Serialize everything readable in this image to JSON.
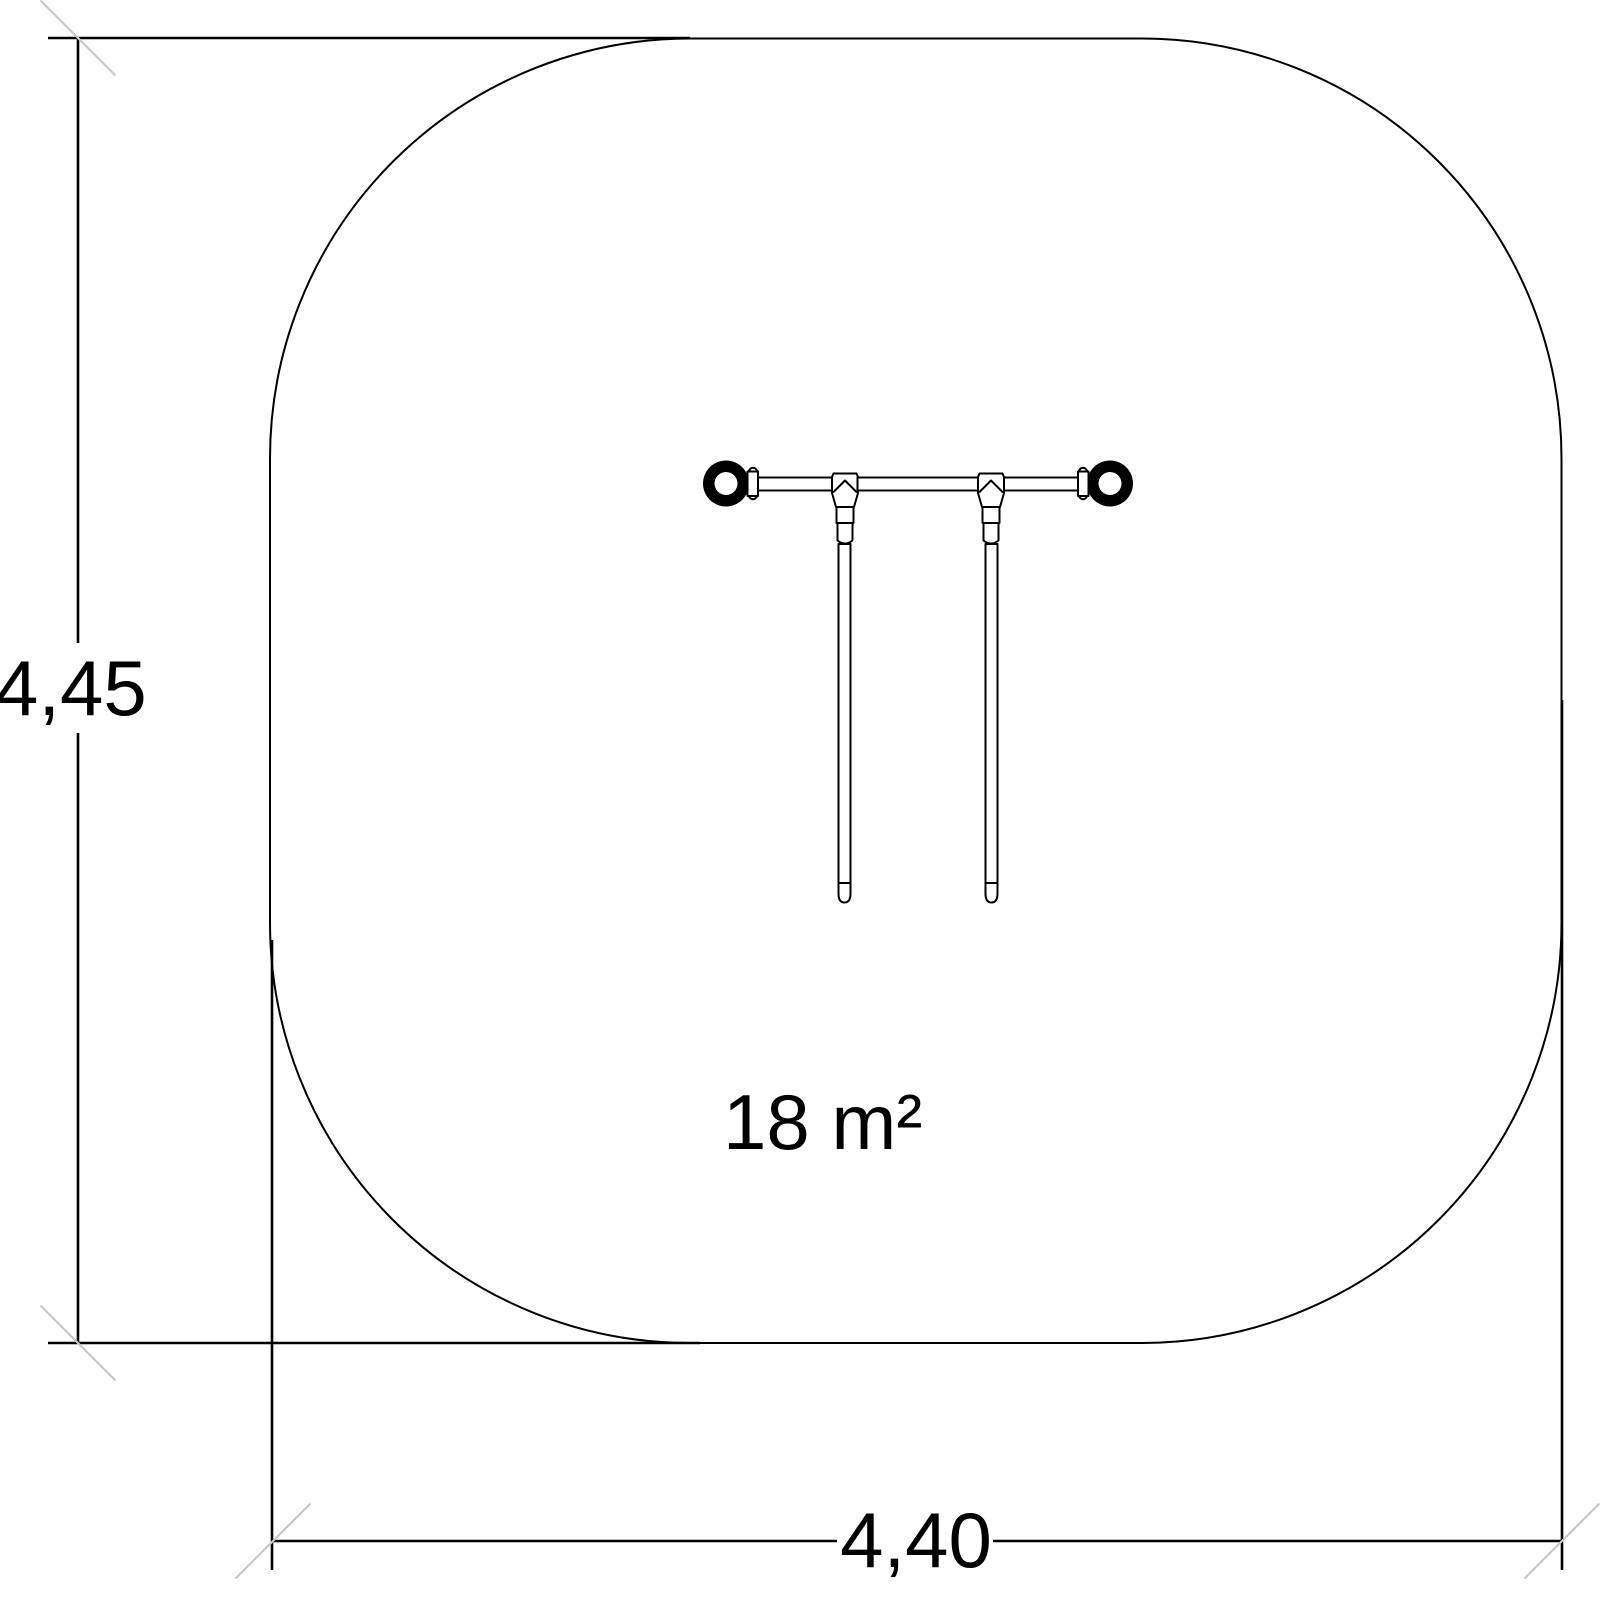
{
  "drawing": {
    "height_dimension": "4,45",
    "width_dimension": "4,40",
    "area_label": "18 m²"
  },
  "colors": {
    "line": "#000000",
    "dimension_tick": "#c8c8c8",
    "background": "#ffffff"
  }
}
